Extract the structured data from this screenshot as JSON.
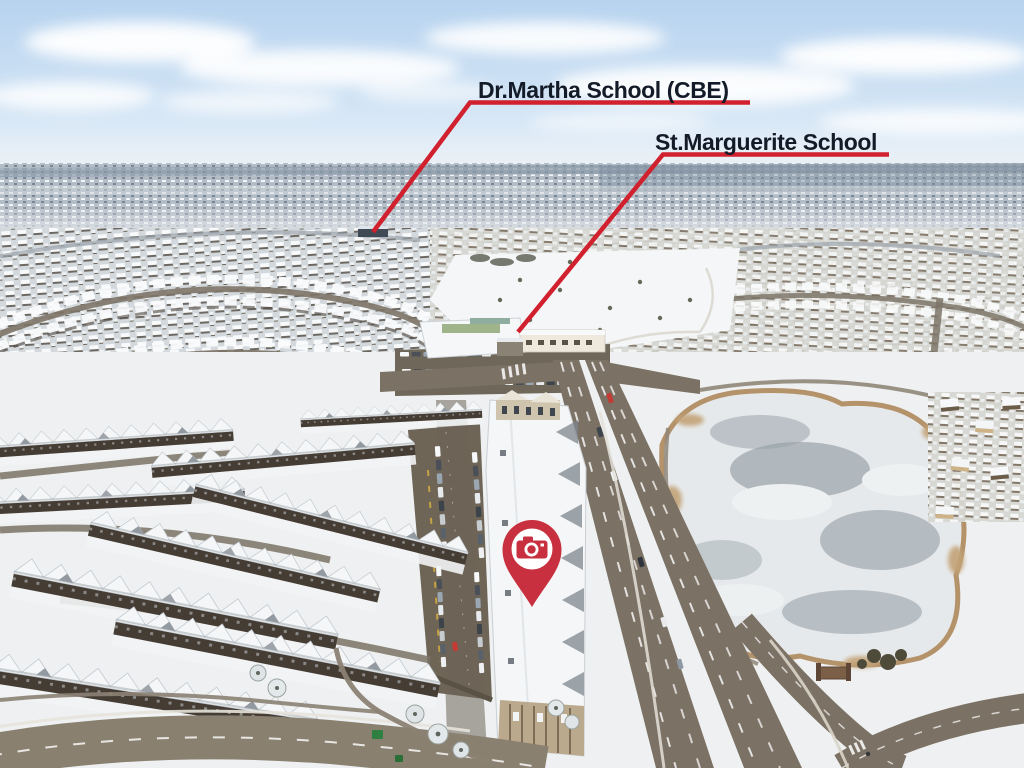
{
  "photo": {
    "subject": "aerial-winter-neighbourhood-photo"
  },
  "annotations": {
    "school_labels": [
      {
        "label": "Dr.Martha School (CBE)"
      },
      {
        "label": "St.Marguerite School"
      }
    ],
    "pin": {
      "icon": "camera-icon"
    }
  },
  "colors": {
    "annotation-red": "#d1202e",
    "pin-red": "#c83040",
    "label-ink": "#141b28",
    "sky-top": "#b7d3ef",
    "sky-low": "#edf4fa",
    "far-haze": "#8a99a8",
    "snow": "#eef0f1",
    "field-snow": "#f4f6f7",
    "road": "#7b7164",
    "road-light": "#8a8070",
    "asphalt-dark": "#6e6557",
    "pond-ice": "#99a3aa",
    "reed": "#b4926a",
    "wall-dark": "#453c34",
    "roof-white": "#f4f6f7"
  }
}
